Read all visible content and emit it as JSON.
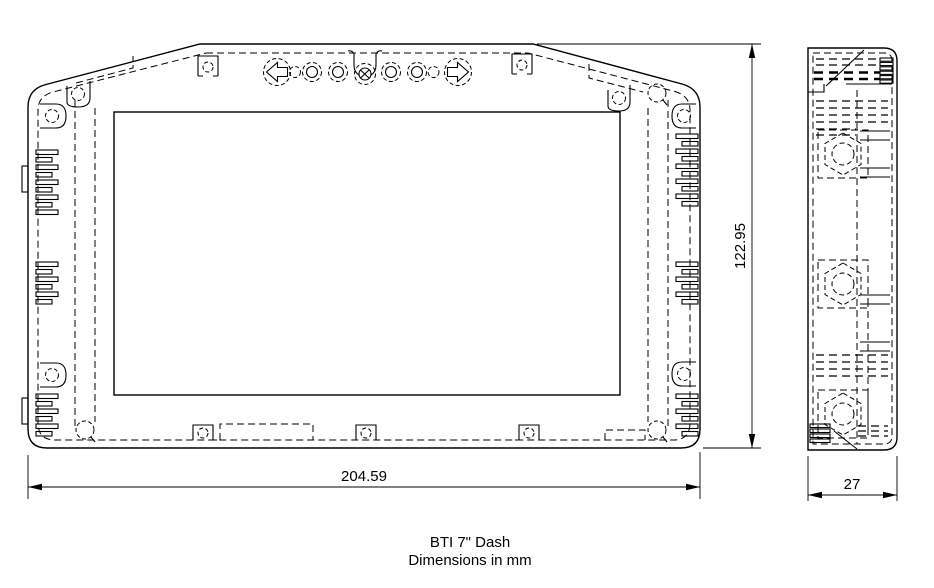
{
  "drawing": {
    "title": "BTI 7\" Dash",
    "subtitle": "Dimensions in mm",
    "dimensions": {
      "front_width": "204.59",
      "front_height": "122.95",
      "side_depth": "27"
    },
    "icons": {
      "nav_left_button": "left-arrow",
      "nav_right_button": "right-arrow"
    },
    "colors": {
      "line": "#000000",
      "background": "#ffffff"
    }
  }
}
